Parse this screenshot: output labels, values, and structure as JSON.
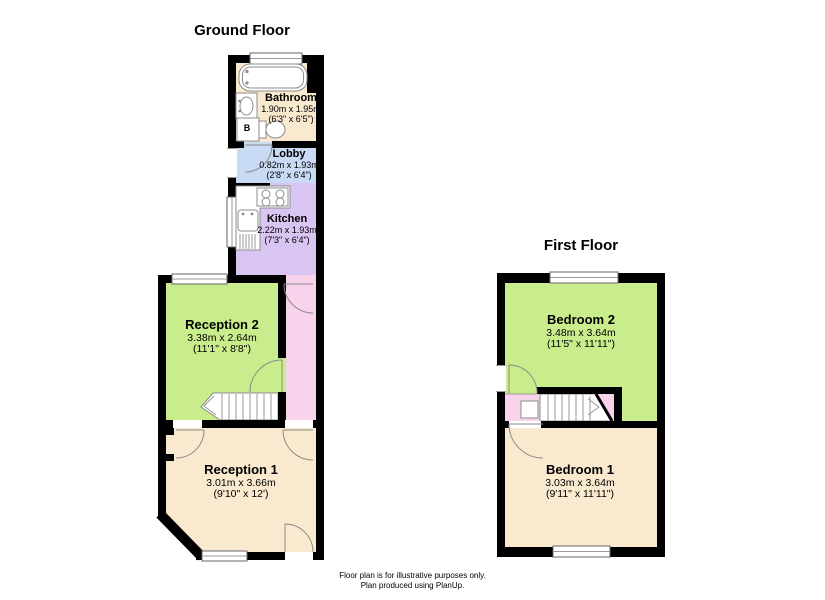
{
  "ground_floor": {
    "title": "Ground Floor",
    "boiler_label": "B",
    "rooms": {
      "bathroom": {
        "name": "Bathroom",
        "metric": "1.90m x 1.95m",
        "imperial": "(6'3\" x 6'5\")"
      },
      "lobby": {
        "name": "Lobby",
        "metric": "0.82m x 1.93m",
        "imperial": "(2'8\" x 6'4\")"
      },
      "kitchen": {
        "name": "Kitchen",
        "metric": "2.22m x 1.93m",
        "imperial": "(7'3\" x 6'4\")"
      },
      "reception2": {
        "name": "Reception 2",
        "metric": "3.38m x 2.64m",
        "imperial": "(11'1\" x 8'8\")"
      },
      "reception1": {
        "name": "Reception 1",
        "metric": "3.01m x 3.66m",
        "imperial": "(9'10\" x 12')"
      }
    }
  },
  "first_floor": {
    "title": "First Floor",
    "rooms": {
      "bedroom2": {
        "name": "Bedroom 2",
        "metric": "3.48m x 3.64m",
        "imperial": "(11'5\" x 11'11\")"
      },
      "bedroom1": {
        "name": "Bedroom 1",
        "metric": "3.03m x 3.64m",
        "imperial": "(9'11\" x 11'11\")"
      }
    }
  },
  "footer": {
    "line1": "Floor plan is for illustrative purposes only.",
    "line2": "Plan produced using PlanUp."
  },
  "colors": {
    "wall": "#000000",
    "room_green": "#c9ec8d",
    "room_beige": "#f8e9cf",
    "room_blue": "#c9daf5",
    "room_purple": "#d9c5f2",
    "room_pink": "#f9d2ec",
    "fixture_stroke": "#8c8c8c"
  }
}
